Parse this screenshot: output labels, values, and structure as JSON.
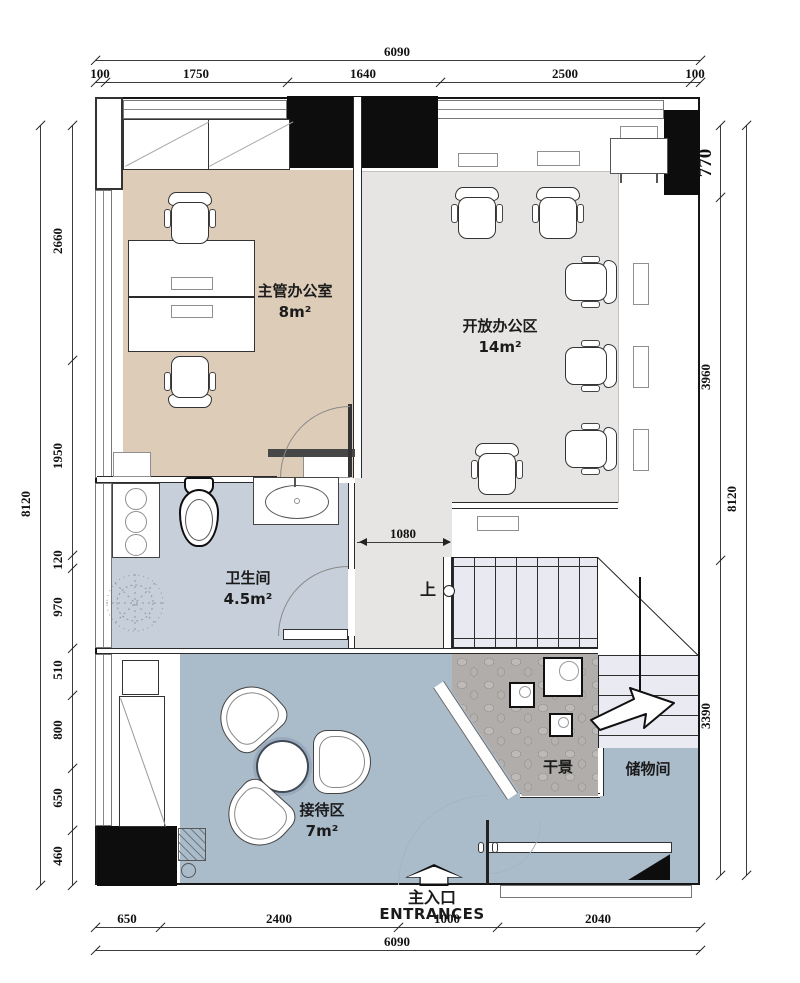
{
  "rooms": {
    "manager": {
      "name": "主管办公室",
      "area": "8m²"
    },
    "open": {
      "name": "开放办公区",
      "area": "14m²"
    },
    "bath": {
      "name": "卫生间",
      "area": "4.5m²"
    },
    "reception": {
      "name": "接待区",
      "area": "7m²"
    },
    "dry": {
      "name": "干景"
    },
    "storage": {
      "name": "储物间"
    }
  },
  "entrance": {
    "cn": "主入口",
    "en": "ENTRANCES"
  },
  "stairs": {
    "up": "上"
  },
  "dims": {
    "top_total": "6090",
    "top": [
      "100",
      "1750",
      "1640",
      "2500",
      "100"
    ],
    "left_total": "8120",
    "left": [
      "2660",
      "1950",
      "120",
      "970",
      "510",
      "800",
      "650",
      "460"
    ],
    "right": [
      "770",
      "3960",
      "3390"
    ],
    "right_total": "8120",
    "bottom": [
      "650",
      "2400",
      "1000",
      "2040"
    ],
    "bottom_total": "6090",
    "stair_clear": "1080"
  },
  "colors": {
    "manager_floor": "#ddccb7",
    "open_floor": "#e6e5e3",
    "bath_floor": "#c6cfda",
    "reception_floor": "#aabbca",
    "stair_fill": "#e9e9f2",
    "gravel": "#b0adaa",
    "wall_black": "#0d0d0d"
  }
}
